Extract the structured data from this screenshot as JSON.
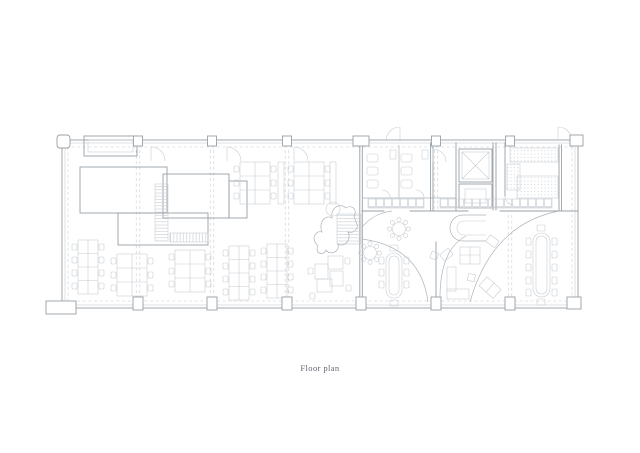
{
  "page": {
    "background": "#ffffff"
  },
  "figure": {
    "caption": "Floor plan",
    "kind": "architectural-floor-plan"
  },
  "colors": {
    "background": "#ffffff",
    "line_strong": "#98a0a7",
    "line_medium": "#aeb4ba",
    "line_light": "#c7ccd1",
    "caption": "#5f646b"
  }
}
